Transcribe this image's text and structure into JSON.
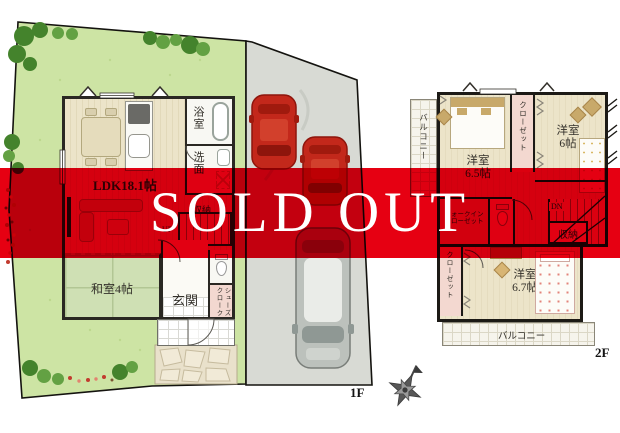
{
  "banner": {
    "text": "SOLD OUT",
    "color": "#e60012",
    "text_color": "#ffffff"
  },
  "floor1": {
    "floor_label": "1F",
    "ldk_label": "LDK18.1帖",
    "bath_label": "浴室",
    "washroom_label": "洗面",
    "storage_label": "収納",
    "stairs_label": "UP",
    "japanese_room_label": "和室4帖",
    "entrance_label": "玄関",
    "shoes_cloak_line1": "シューズ",
    "shoes_cloak_line2": "クローク"
  },
  "floor2": {
    "floor_label": "2F",
    "balcony_left_label": "バルコニー",
    "bedroom65_name": "洋室",
    "bedroom65_size": "6.5帖",
    "closet_top_label": "クローゼット",
    "bedroom6_name": "洋室",
    "bedroom6_size": "6帖",
    "wic_line1": "ウォークイン",
    "wic_line2": "クローゼット",
    "stairs_label": "DN",
    "storage_label": "収納",
    "closet_bottom_label": "クローゼット",
    "bedroom67_name": "洋室",
    "bedroom67_size": "6.7帖",
    "balcony_bottom_label": "バルコニー"
  },
  "colors": {
    "banner_red": "#e60012",
    "grass_green": "#cde4a4",
    "driveway_gray": "#d8dad4",
    "tatami_green": "#cfe0b4",
    "wood_floor": "#ece4c9",
    "closet_pink": "#f3d8d0",
    "car_red": "#c3281b",
    "car_gray": "#bcc1bc"
  }
}
